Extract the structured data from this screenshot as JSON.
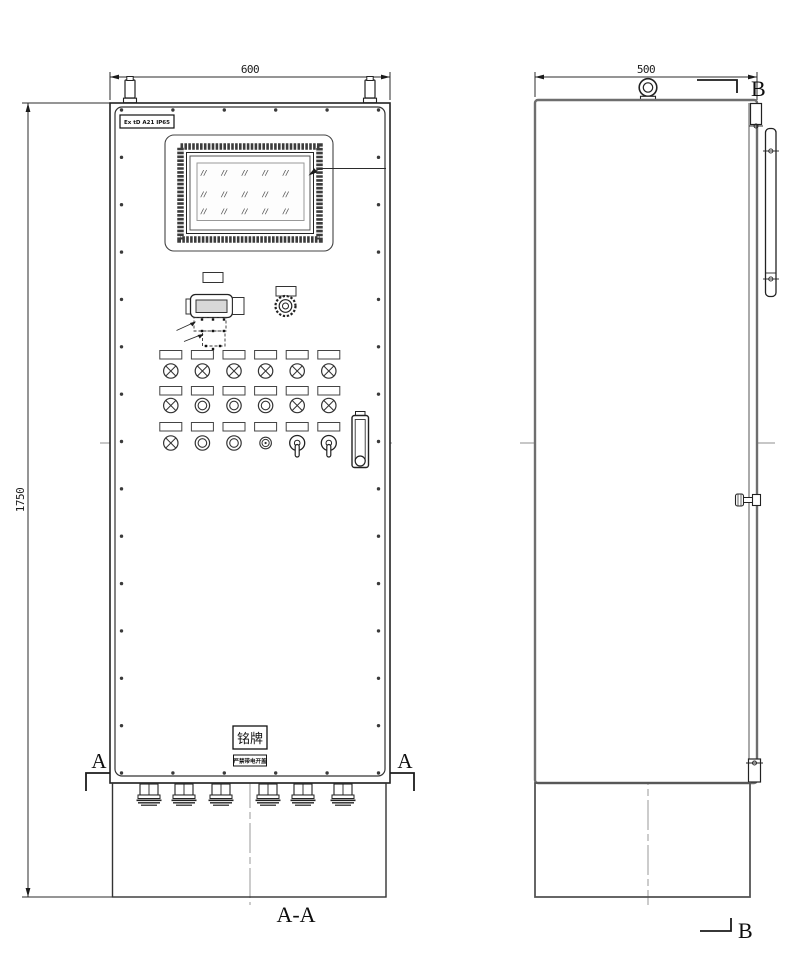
{
  "drawing": {
    "view_title": "A-A",
    "section_marker_a": "A",
    "section_marker_b": "B"
  },
  "dimensions": {
    "front_width": "600",
    "front_height": "1750",
    "side_depth": "500"
  },
  "labels": {
    "ex_marking": "Ex tD A21 IP65",
    "nameplate": "铭牌",
    "warning": "严禁带电开盖"
  },
  "screen": {
    "hatch_glyph": "//",
    "hatch_cols": 5,
    "hatch_rows": 3
  },
  "control_rows": [
    [
      "lamp",
      "lamp",
      "lamp",
      "lamp",
      "lamp",
      "lamp"
    ],
    [
      "lamp",
      "button",
      "button",
      "button",
      "lamp",
      "lamp"
    ],
    [
      "lamp",
      "button",
      "button",
      "small-button",
      "selector-switch",
      "selector-switch"
    ]
  ],
  "cable_glands": {
    "count": 6
  },
  "screws": {
    "side_count": 15,
    "top_bottom_count": 6
  },
  "colors": {
    "line": "#2b2b2b",
    "centerline": "#8f8f8f",
    "bezel": "#3c3c3c"
  }
}
